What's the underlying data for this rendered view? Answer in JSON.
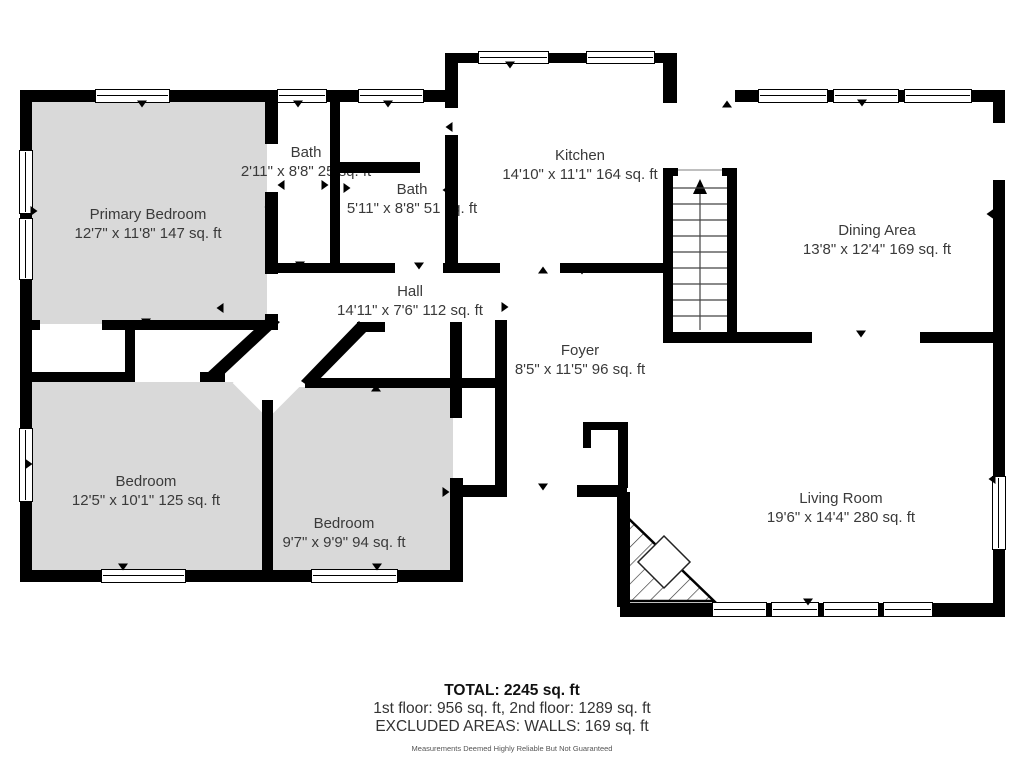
{
  "title": "Floor Plan",
  "rooms": [
    {
      "id": "primary-bedroom",
      "name": "Primary Bedroom",
      "dims": "12'7\" x 11'8\" 147 sq. ft"
    },
    {
      "id": "bath-1",
      "name": "Bath",
      "dims": "2'11\" x 8'8\" 25 sq. ft"
    },
    {
      "id": "bath-2",
      "name": "Bath",
      "dims": "5'11\" x 8'8\" 51 sq. ft"
    },
    {
      "id": "kitchen",
      "name": "Kitchen",
      "dims": "14'10\" x 11'1\" 164 sq. ft"
    },
    {
      "id": "dining-area",
      "name": "Dining Area",
      "dims": "13'8\" x 12'4\" 169 sq. ft"
    },
    {
      "id": "hall",
      "name": "Hall",
      "dims": "14'11\" x 7'6\" 112 sq. ft"
    },
    {
      "id": "foyer",
      "name": "Foyer",
      "dims": "8'5\" x 11'5\" 96 sq. ft"
    },
    {
      "id": "bedroom-1",
      "name": "Bedroom",
      "dims": "12'5\" x 10'1\" 125 sq. ft"
    },
    {
      "id": "bedroom-2",
      "name": "Bedroom",
      "dims": "9'7\" x 9'9\" 94 sq. ft"
    },
    {
      "id": "living-room",
      "name": "Living Room",
      "dims": "19'6\" x 14'4\" 280 sq. ft"
    }
  ],
  "footer": {
    "total": "TOTAL: 2245 sq. ft",
    "floors": "1st floor: 956 sq. ft, 2nd floor: 1289 sq. ft",
    "excluded": "EXCLUDED AREAS: WALLS: 169 sq. ft",
    "disclaimer": "Measurements Deemed Highly Reliable But Not Guaranteed"
  },
  "colors": {
    "wall": "#000000",
    "bedroom_fill": "#d9d9d9",
    "background": "#ffffff",
    "label_text": "#3a3a3a"
  }
}
